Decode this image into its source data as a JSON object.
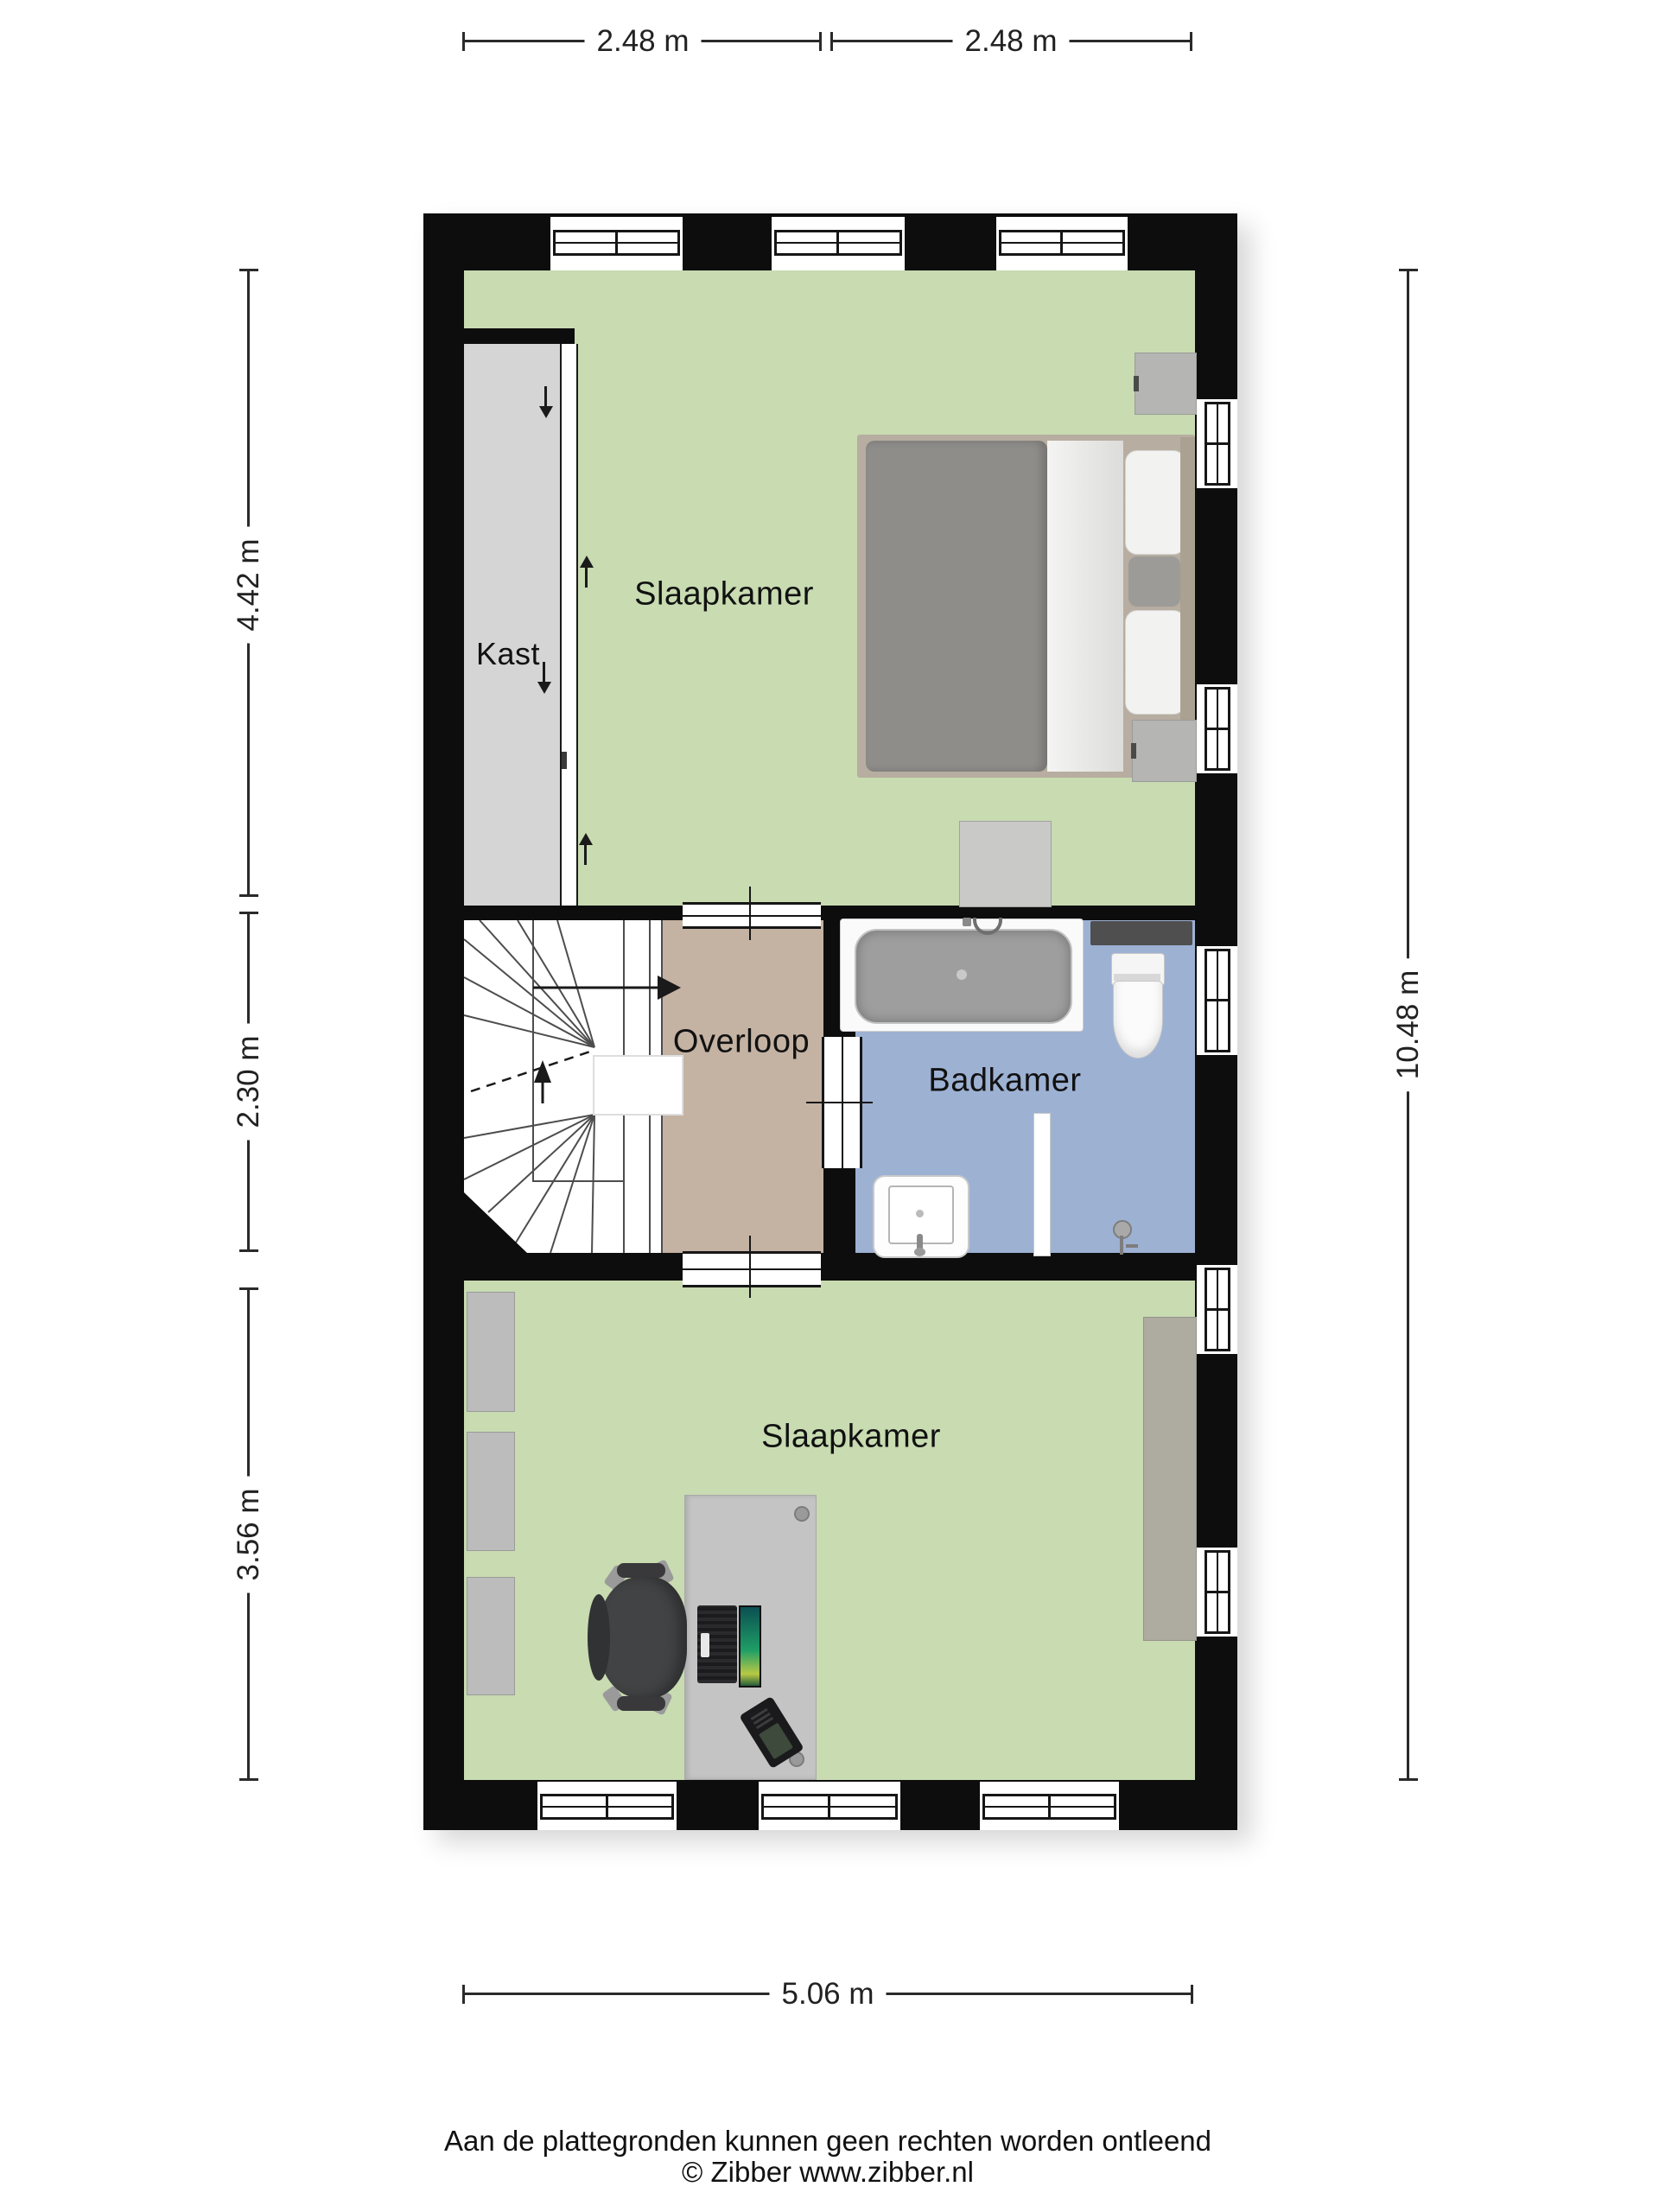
{
  "plan": {
    "rooms": {
      "bedroom_top": {
        "label": "Slaapkamer"
      },
      "closet": {
        "label": "Kast"
      },
      "landing": {
        "label": "Overloop"
      },
      "bathroom": {
        "label": "Badkamer"
      },
      "bedroom_bottom": {
        "label": "Slaapkamer"
      }
    },
    "dimensions": {
      "top_left": "2.48 m",
      "top_right": "2.48 m",
      "left_upper": "4.42 m",
      "left_middle": "2.30 m",
      "left_lower": "3.56 m",
      "right_full": "10.48 m",
      "bottom": "5.06 m"
    },
    "colors": {
      "floor_green": "#c8dbb1",
      "floor_tan": "#c4b2a3",
      "floor_blue": "#9db1d3",
      "closet_grey": "#d5d5d5",
      "wall_black": "#0d0d0d"
    }
  },
  "footer": {
    "disclaimer": "Aan de plattegronden kunnen geen rechten worden ontleend",
    "copyright": "© Zibber www.zibber.nl"
  }
}
